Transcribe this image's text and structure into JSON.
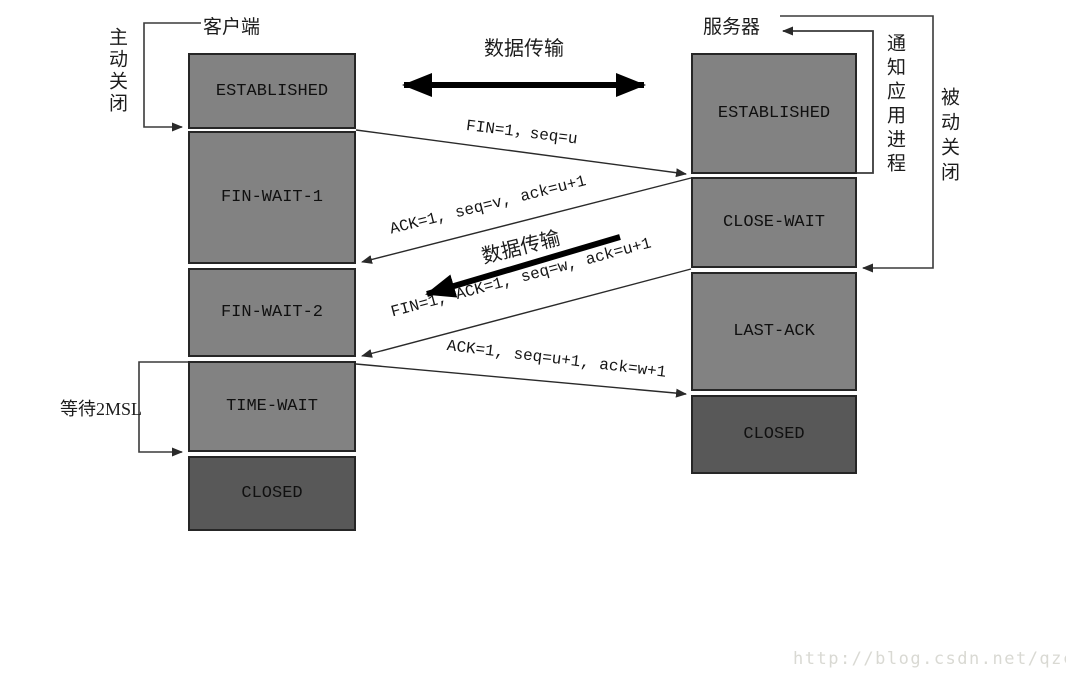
{
  "colors": {
    "box_fill": "#828282",
    "box_fill_dark": "#585858",
    "box_border": "#262626",
    "line": "#3a3a3a",
    "thick_arrow": "#000000",
    "watermark": "#d9d9d3"
  },
  "client": {
    "title": "客户端",
    "active_close": "主动关闭",
    "wait_2msl": "等待2MSL",
    "states": [
      "ESTABLISHED",
      "FIN-WAIT-1",
      "FIN-WAIT-2",
      "TIME-WAIT",
      "CLOSED"
    ]
  },
  "server": {
    "title": "服务器",
    "notify_app": "通知应用进程",
    "passive_close": "被动关闭",
    "states": [
      "ESTABLISHED",
      "CLOSE-WAIT",
      "LAST-ACK",
      "CLOSED"
    ]
  },
  "messages": {
    "data_transfer_top": "数据传输",
    "fin": "FIN=1，seq=u",
    "ack": "ACK=1, seq=v, ack=u+1",
    "data_transfer_mid": "数据传输",
    "fin_ack": "FIN=1, ACK=1, seq=w, ack=u+1",
    "final_ack": "ACK=1, seq=u+1, ack=w+1"
  },
  "watermark": {
    "text": "http://blog.csdn.net/qzcsu"
  }
}
